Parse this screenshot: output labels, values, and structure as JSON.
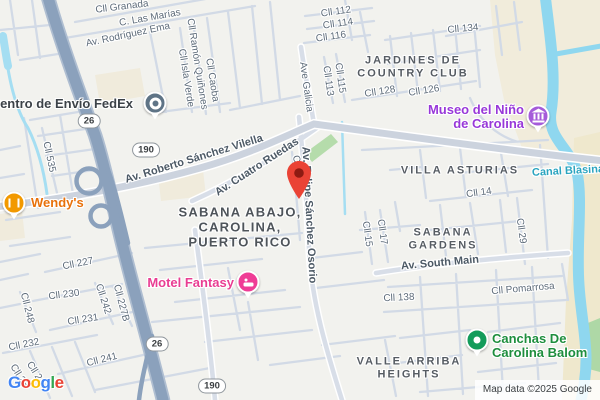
{
  "map": {
    "attribution": "Map data ©2025 Google",
    "logo_letters": [
      {
        "ch": "G",
        "color": "#4285F4"
      },
      {
        "ch": "o",
        "color": "#EA4335"
      },
      {
        "ch": "o",
        "color": "#FBBC05"
      },
      {
        "ch": "g",
        "color": "#4285F4"
      },
      {
        "ch": "l",
        "color": "#34A853"
      },
      {
        "ch": "e",
        "color": "#EA4335"
      }
    ],
    "route_badges": [
      {
        "label": "26",
        "x": 89,
        "y": 121
      },
      {
        "label": "190",
        "x": 146,
        "y": 150
      },
      {
        "label": "26",
        "x": 157,
        "y": 344
      },
      {
        "label": "190",
        "x": 212,
        "y": 386
      }
    ],
    "street_labels": [
      {
        "text": "Cll Granada",
        "x": 122,
        "y": 7,
        "r": -7
      },
      {
        "text": "C. Las Marías",
        "x": 150,
        "y": 18,
        "r": -10
      },
      {
        "text": "Av. Rodríguez Ema",
        "x": 128,
        "y": 35,
        "r": -12
      },
      {
        "text": "Cll Ramón Quiñones",
        "x": 197,
        "y": 64,
        "r": 81
      },
      {
        "text": "Cll Isla Verde",
        "x": 186,
        "y": 78,
        "r": 81
      },
      {
        "text": "Cll Caoba",
        "x": 212,
        "y": 80,
        "r": 81
      },
      {
        "text": "Cll 112",
        "x": 336,
        "y": 12,
        "r": -8
      },
      {
        "text": "Cll 114",
        "x": 338,
        "y": 24,
        "r": -8
      },
      {
        "text": "Cll 116",
        "x": 331,
        "y": 37,
        "r": -8
      },
      {
        "text": "Ave Galicia",
        "x": 306,
        "y": 87,
        "r": 82
      },
      {
        "text": "Cll 115",
        "x": 340,
        "y": 78,
        "r": 82
      },
      {
        "text": "Cll 113",
        "x": 328,
        "y": 81,
        "r": 82
      },
      {
        "text": "Cll 128",
        "x": 380,
        "y": 92,
        "r": -9
      },
      {
        "text": "Cll 126",
        "x": 424,
        "y": 91,
        "r": -9
      },
      {
        "text": "Cll 134",
        "x": 463,
        "y": 29,
        "r": -5
      },
      {
        "text": "Cll 535",
        "x": 49,
        "y": 157,
        "r": 78
      },
      {
        "text": "Av. Roberto Sánchez Vilella",
        "x": 194,
        "y": 159,
        "r": -17,
        "cls": "avenue"
      },
      {
        "text": "Av. Cuatro Ruedas",
        "x": 257,
        "y": 167,
        "r": -33,
        "cls": "avenue"
      },
      {
        "text": "C",
        "x": 296,
        "y": 159,
        "r": 78
      },
      {
        "text": "Av. Felipe Sánchez Osorio",
        "x": 309,
        "y": 215,
        "r": 87,
        "cls": "avenue"
      },
      {
        "text": "Cll 14",
        "x": 479,
        "y": 193,
        "r": -8
      },
      {
        "text": "Cll 15",
        "x": 367,
        "y": 234,
        "r": 82
      },
      {
        "text": "Cll 17",
        "x": 382,
        "y": 232,
        "r": 82
      },
      {
        "text": "Cll 29",
        "x": 521,
        "y": 231,
        "r": 82
      },
      {
        "text": "Av. South Main",
        "x": 440,
        "y": 263,
        "r": -5,
        "cls": "avenue"
      },
      {
        "text": "Cll 138",
        "x": 399,
        "y": 298,
        "r": -3
      },
      {
        "text": "Cll Pomarrosa",
        "x": 523,
        "y": 289,
        "r": -5
      },
      {
        "text": "Cll 227",
        "x": 78,
        "y": 264,
        "r": -11
      },
      {
        "text": "Cll 230",
        "x": 64,
        "y": 295,
        "r": -7
      },
      {
        "text": "Cll 248",
        "x": 27,
        "y": 308,
        "r": 76
      },
      {
        "text": "Cll 242",
        "x": 103,
        "y": 299,
        "r": 72
      },
      {
        "text": "Cll 227B",
        "x": 121,
        "y": 303,
        "r": 75
      },
      {
        "text": "Cll 231",
        "x": 83,
        "y": 320,
        "r": -9
      },
      {
        "text": "Cll 232",
        "x": 24,
        "y": 345,
        "r": -11
      },
      {
        "text": "Cll 241",
        "x": 102,
        "y": 360,
        "r": -14
      },
      {
        "text": "Cll 25",
        "x": 19,
        "y": 376,
        "r": 58
      },
      {
        "text": "Cll 2",
        "x": 34,
        "y": 371,
        "r": 58
      }
    ],
    "area_labels": [
      {
        "lines": [
          "JARDINES DE",
          "COUNTRY CLUB"
        ],
        "x": 413,
        "y": 67
      },
      {
        "lines": [
          "SABANA ABAJO,",
          "CAROLINA,",
          "PUERTO RICO"
        ],
        "x": 240,
        "y": 228,
        "cls": "locality"
      },
      {
        "lines": [
          "VILLA ASTURIAS"
        ],
        "x": 460,
        "y": 171
      },
      {
        "lines": [
          "SABANA",
          "GARDENS"
        ],
        "x": 443,
        "y": 239
      },
      {
        "lines": [
          "VALLE ARRIBA",
          "HEIGHTS"
        ],
        "x": 409,
        "y": 368
      }
    ],
    "water_labels": [
      {
        "text": "Canal Blasina",
        "x": 568,
        "y": 171,
        "r": -3,
        "color": "#2aa4bf"
      }
    ],
    "pois": [
      {
        "id": "fedex",
        "lines": [
          "Centro de Envío FedEx"
        ],
        "color": "#3c4248",
        "marker": {
          "x": 155,
          "y": 103,
          "type": "ring",
          "color": "#5f7486"
        },
        "label": {
          "x": 133,
          "y": 104,
          "align": "right"
        }
      },
      {
        "id": "wendys",
        "lines": [
          "Wendy's"
        ],
        "color": "#e8710a",
        "marker": {
          "x": 14,
          "y": 203,
          "type": "rest",
          "color": "#f29900"
        },
        "label": {
          "x": 31,
          "y": 203,
          "align": "left"
        }
      },
      {
        "id": "motel-fantasy",
        "lines": [
          "Motel Fantasy"
        ],
        "color": "#e93d92",
        "marker": {
          "x": 248,
          "y": 282,
          "type": "bed",
          "color": "#ef3c96"
        },
        "label": {
          "x": 234,
          "y": 283,
          "align": "right"
        }
      },
      {
        "id": "museo-del-nino",
        "lines": [
          "Museo del Niño",
          "de Carolina"
        ],
        "color": "#9838d9",
        "marker": {
          "x": 538,
          "y": 116,
          "type": "museum",
          "color": "#a55bd9"
        },
        "label": {
          "x": 524,
          "y": 117,
          "align": "right"
        }
      },
      {
        "id": "canchas",
        "lines": [
          "Canchas De",
          "Carolina Balom"
        ],
        "color": "#1e8e3e",
        "marker": {
          "x": 477,
          "y": 340,
          "type": "dot",
          "color": "#149c5b"
        },
        "label": {
          "x": 492,
          "y": 346,
          "align": "left"
        }
      }
    ],
    "pin": {
      "x": 299,
      "y": 199,
      "color": "#EA4335",
      "inner": "#8E1B12"
    }
  }
}
